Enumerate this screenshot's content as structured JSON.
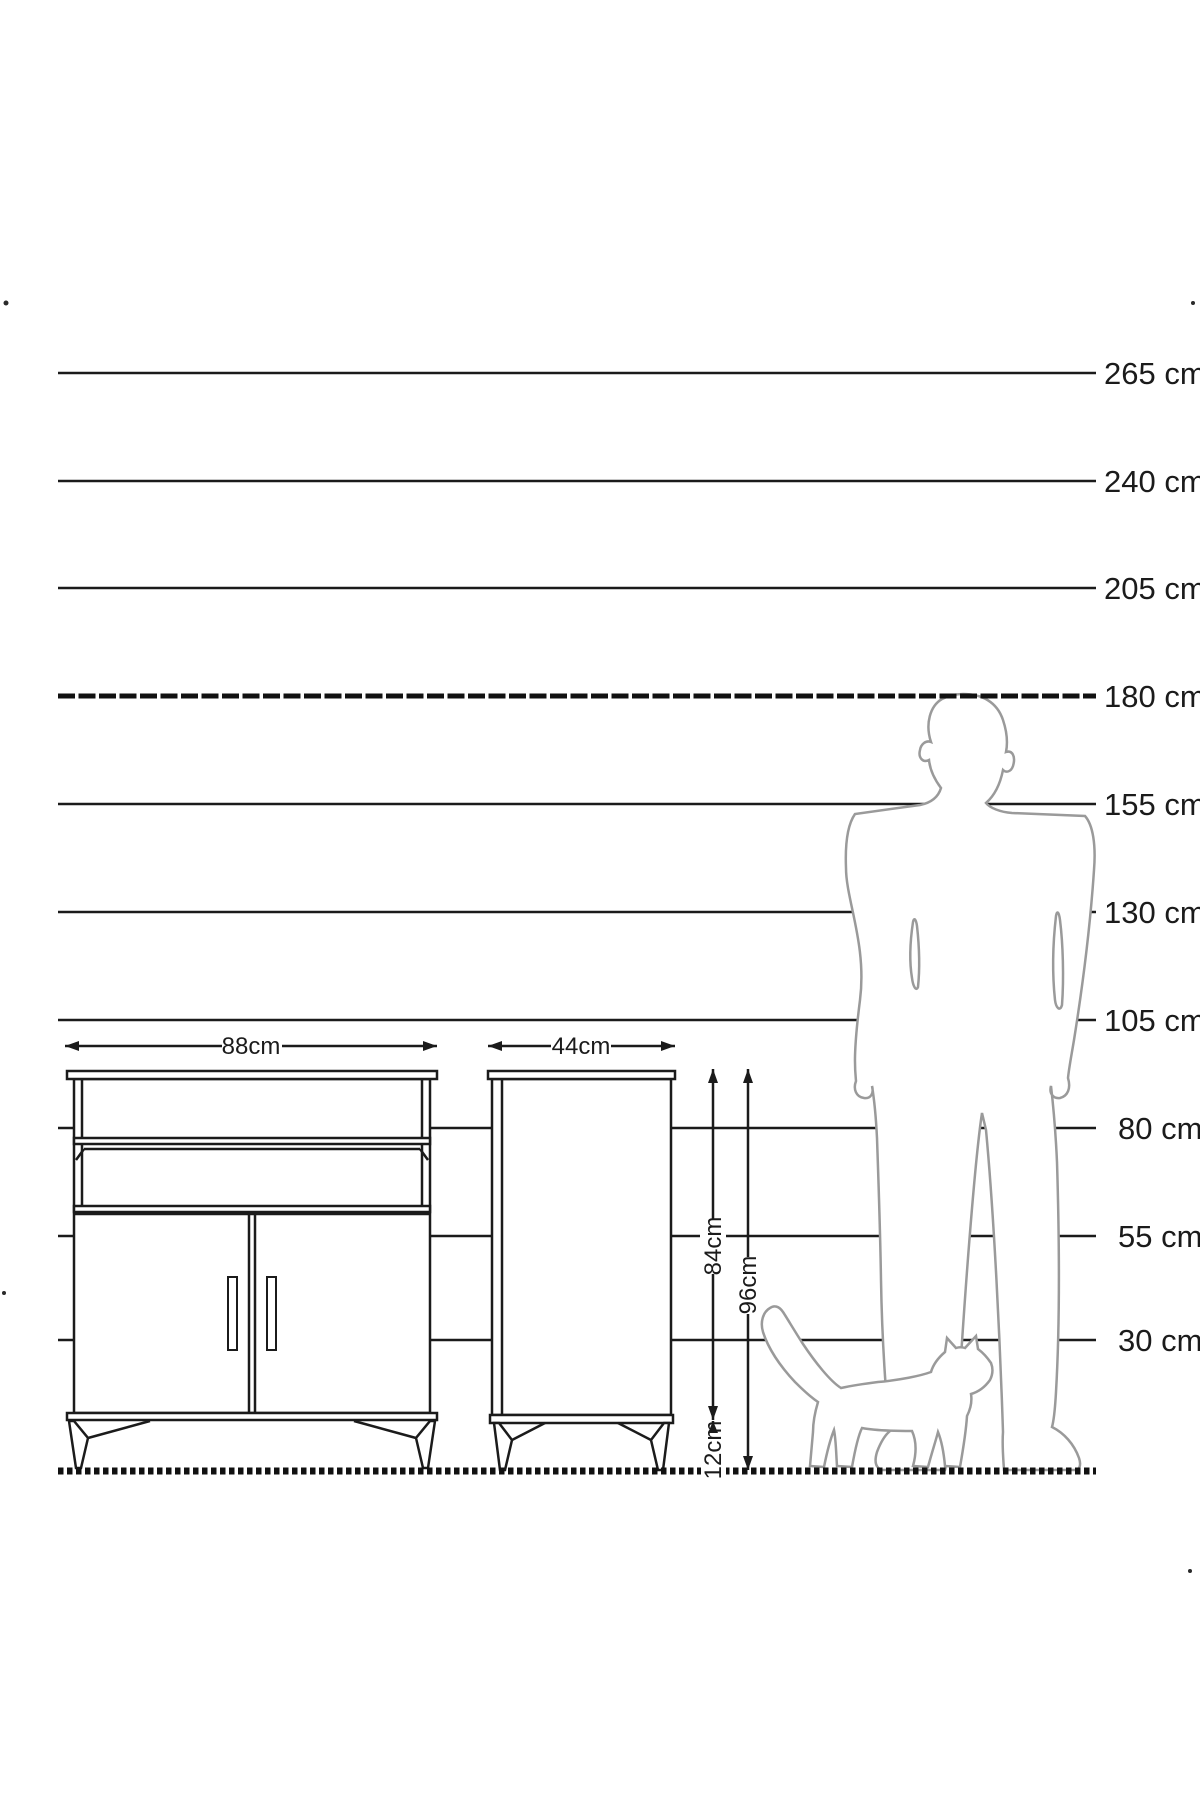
{
  "scale": {
    "unit": "cm",
    "values": [
      265,
      240,
      205,
      180,
      155,
      130,
      105,
      80,
      55,
      30
    ],
    "unit_labels": [
      "265 cm",
      "240 cm",
      "205 cm",
      "180 cm",
      "155 cm",
      "130 cm",
      "105 cm",
      "80 cm",
      "55 cm",
      "30 cm"
    ]
  },
  "dimensions": {
    "cabinet_width": "88cm",
    "side_depth": "44cm",
    "body_height": "84cm",
    "total_height": "96cm",
    "leg_height": "12cm"
  },
  "colors": {
    "line": "#1b1b1b",
    "silhouette": "#9a9a9a",
    "background": "#ffffff"
  }
}
